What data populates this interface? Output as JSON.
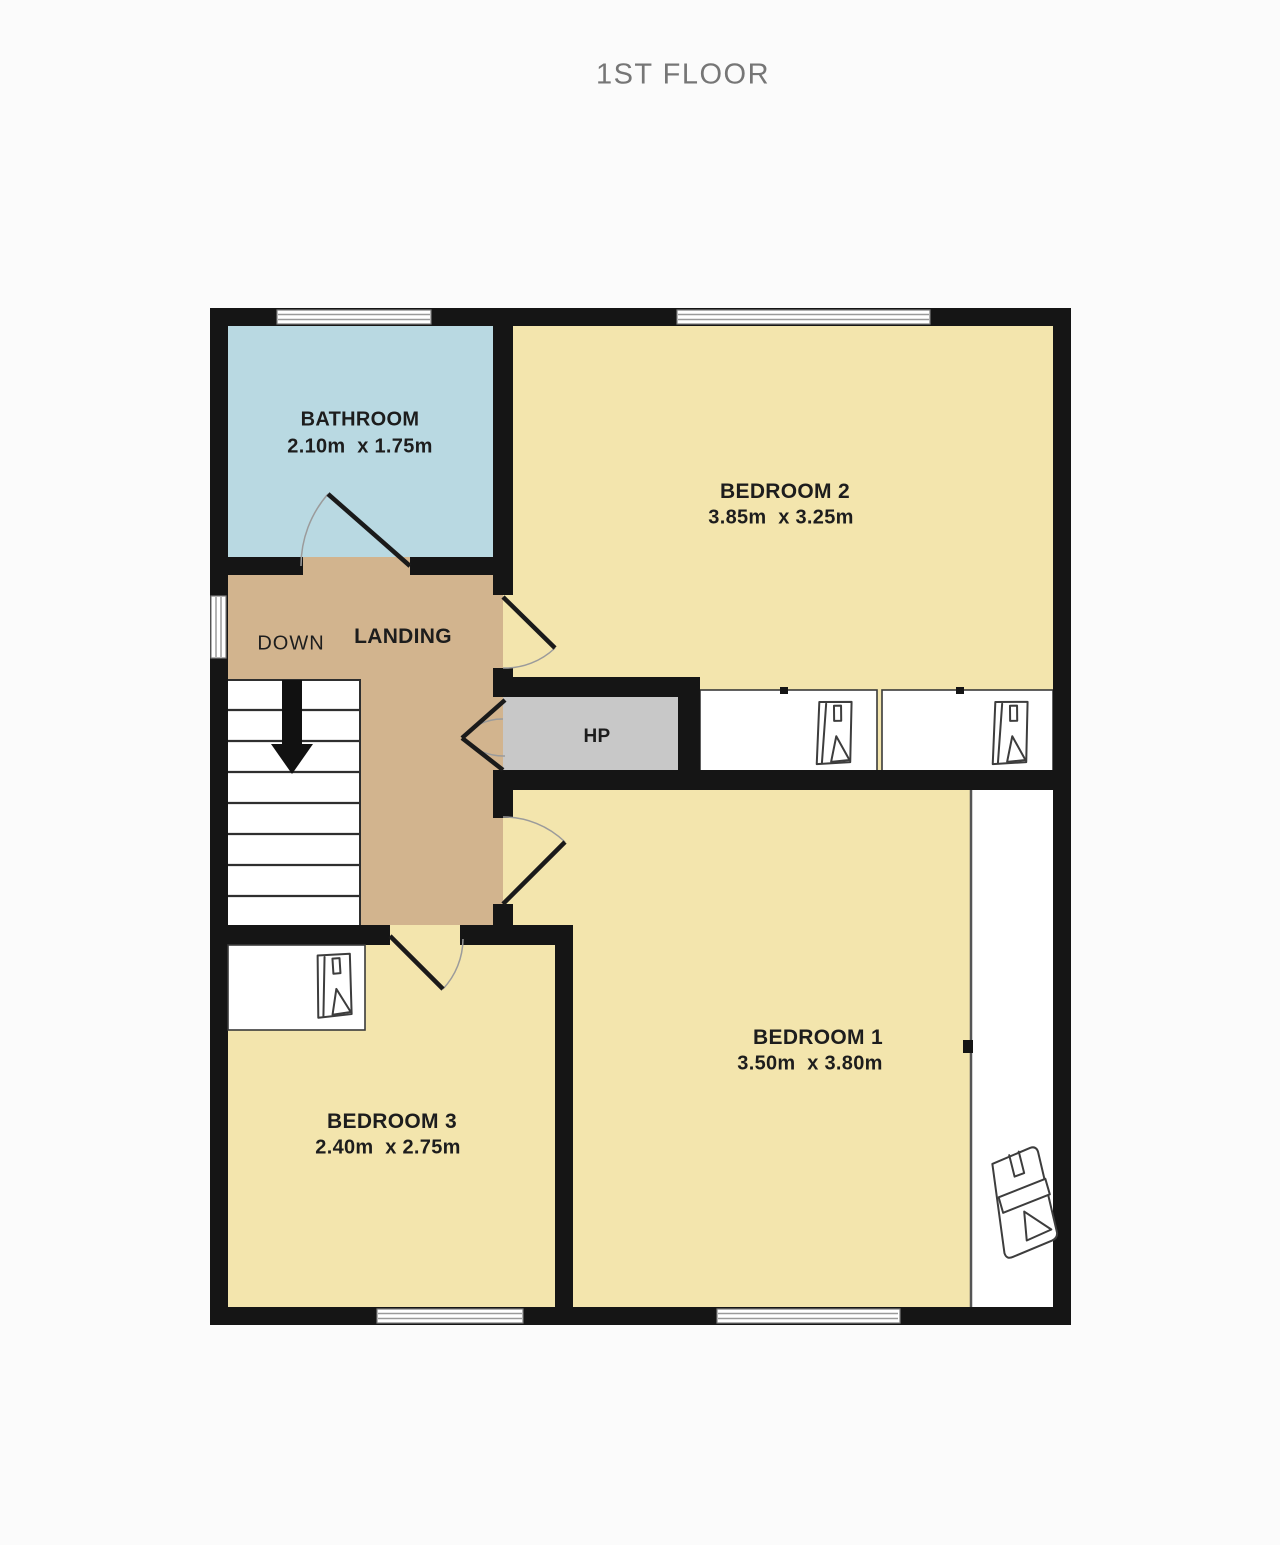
{
  "title": "1ST FLOOR",
  "floor_plan": {
    "rooms": {
      "bathroom": {
        "name": "BATHROOM",
        "dims": "2.10m  x 1.75m"
      },
      "bedroom2": {
        "name": "BEDROOM 2",
        "dims": "3.85m  x 3.25m"
      },
      "bedroom1": {
        "name": "BEDROOM 1",
        "dims": "3.50m  x 3.80m"
      },
      "bedroom3": {
        "name": "BEDROOM 3",
        "dims": "2.40m  x 2.75m"
      },
      "landing": {
        "name": "LANDING"
      },
      "hot_press": {
        "name": "HP"
      }
    },
    "stairs": {
      "label": "DOWN",
      "direction_icon": "down-arrow-icon",
      "steps": 8
    },
    "furniture_icons": [
      "wardrobe-icon",
      "wardrobe-icon",
      "wardrobe-icon",
      "chair-icon"
    ],
    "colors": {
      "wall": "#151515",
      "bathroom_fill": "#b9d9e2",
      "bedroom_fill": "#f3e5ad",
      "landing_fill": "#d2b48e",
      "hot_press_fill": "#c8c8c8",
      "title_text": "#767676",
      "label_text": "#1d1d1d"
    }
  }
}
